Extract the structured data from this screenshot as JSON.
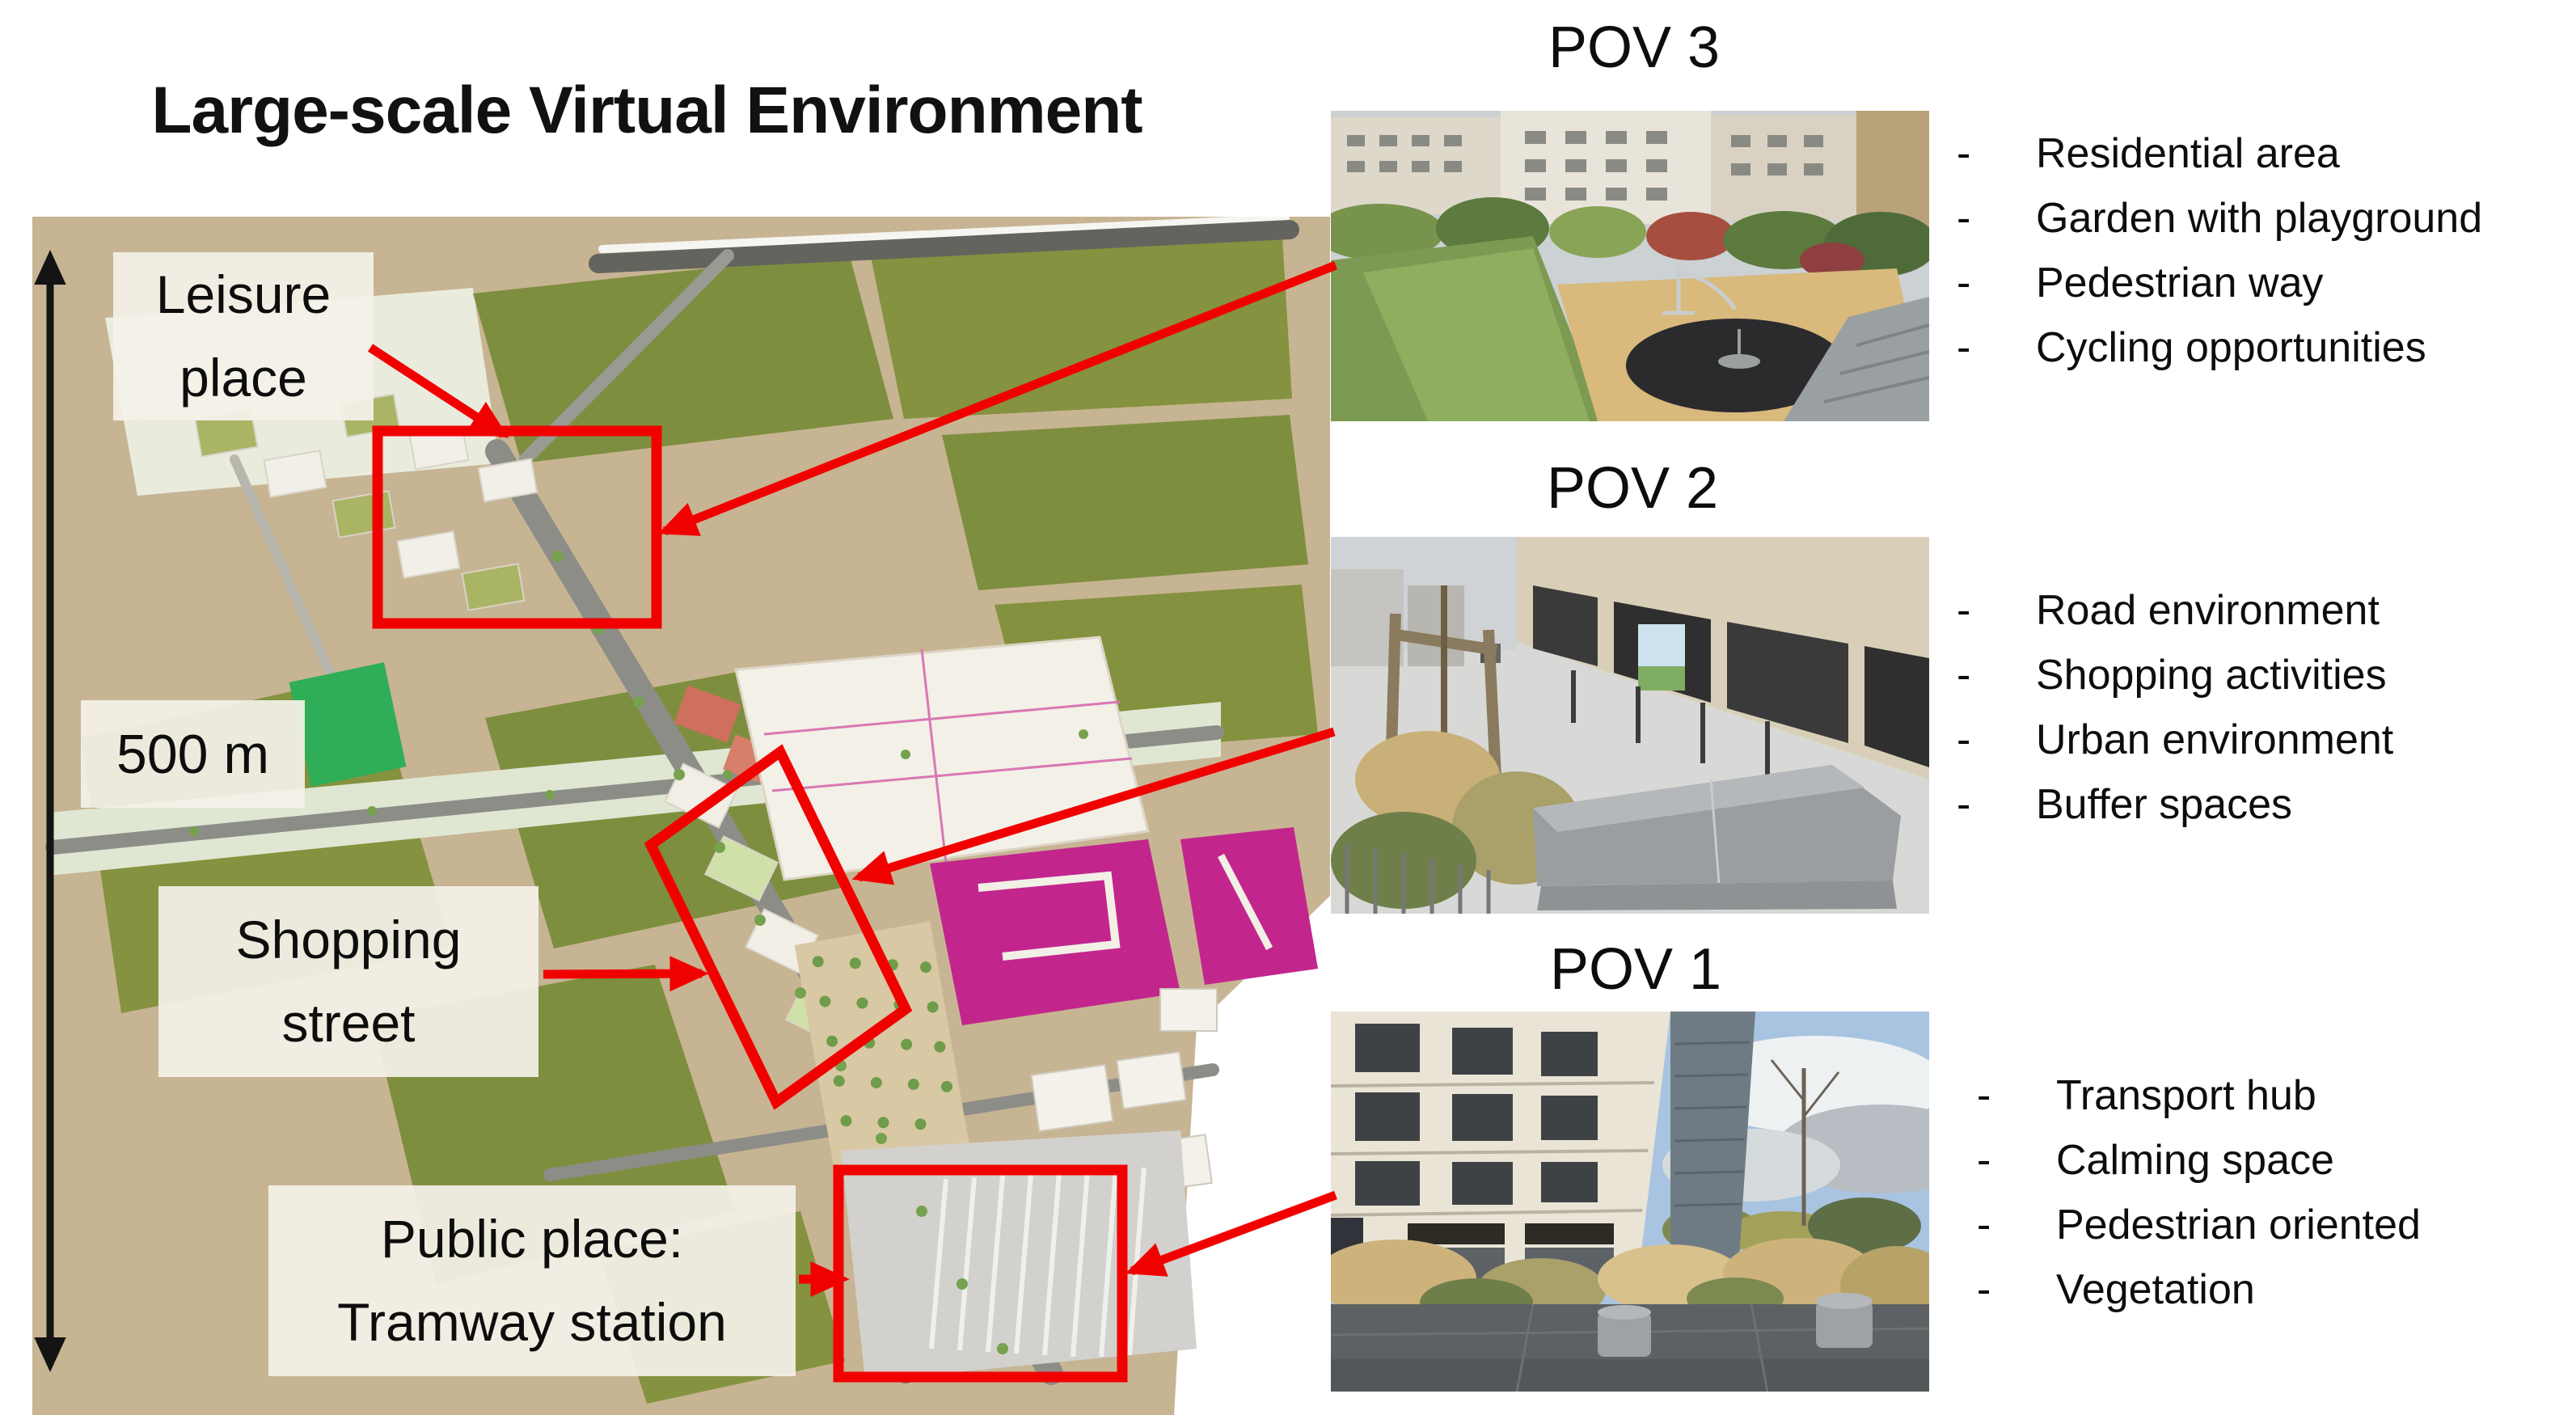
{
  "figure": {
    "title": "Large-scale Virtual Environment",
    "scale": {
      "label": "500 m"
    },
    "bullet_marker": "-",
    "map_labels": {
      "leisure": {
        "line1": "Leisure",
        "line2": "place"
      },
      "shopping": {
        "line1": "Shopping",
        "line2": "street"
      },
      "public": {
        "line1": "Public place:",
        "line2": "Tramway station"
      }
    },
    "povs": [
      {
        "label": "POV 3",
        "bullets": [
          "Residential area",
          "Garden with playground",
          "Pedestrian way",
          "Cycling opportunities"
        ]
      },
      {
        "label": "POV 2",
        "bullets": [
          "Road environment",
          "Shopping activities",
          "Urban environment",
          "Buffer spaces"
        ]
      },
      {
        "label": "POV 1",
        "bullets": [
          "Transport hub",
          "Calming space",
          "Pedestrian oriented",
          "Vegetation"
        ]
      }
    ],
    "colors": {
      "annotation_red": "#f10000",
      "label_background": "#f2efe6",
      "map_ground_tan": "#c7b493",
      "map_field_green": "#7e8e3f",
      "magenta_buildings": "#c2268c"
    }
  }
}
